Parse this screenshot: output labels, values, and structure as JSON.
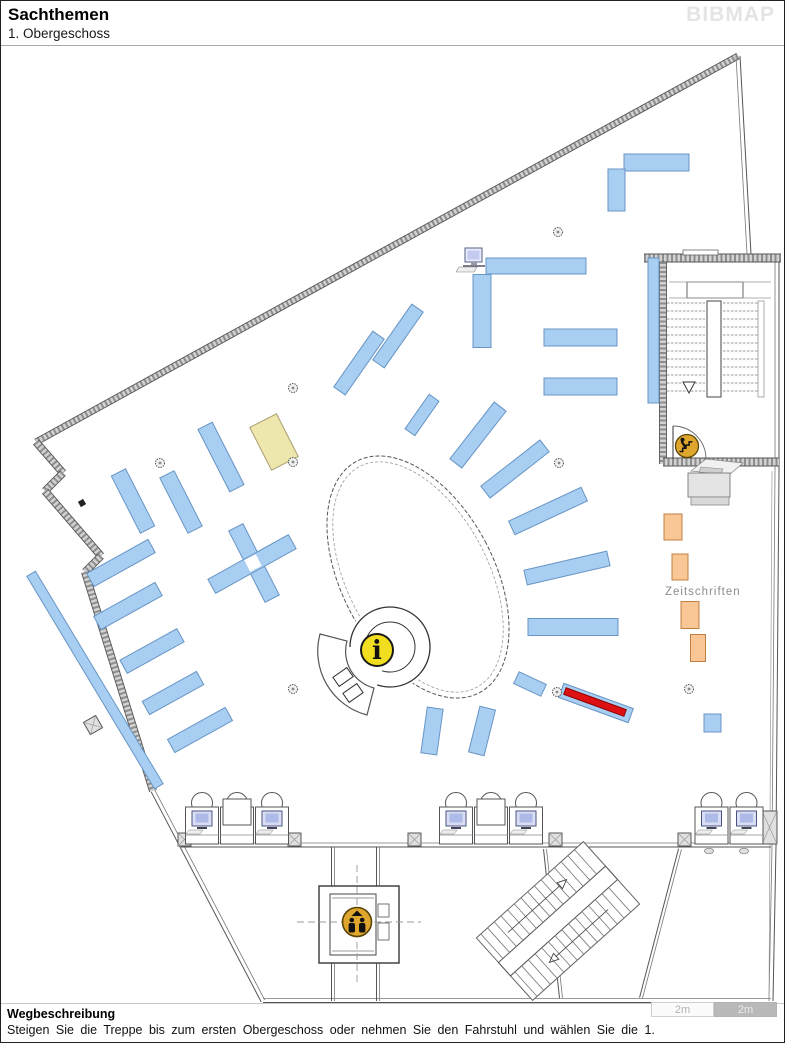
{
  "header": {
    "title": "Sachthemen",
    "subtitle": "1. Obergeschoss",
    "logo": "BIBMAP"
  },
  "footer": {
    "heading": "Wegbeschreibung",
    "text": "Steigen Sie die Treppe bis zum ersten Obergeschoss oder nehmen Sie den Fahrstuhl und wählen Sie die 1.",
    "scale_left": "2m",
    "scale_right": "2m"
  },
  "map": {
    "labels": {
      "zeitschriften": "Zeitschriften"
    },
    "colors": {
      "shelf_blue": "#A8CEF2",
      "shelf_blue_border": "#6795C5",
      "shelf_yellow": "#EDE7AE",
      "shelf_yellow_border": "#A8A070",
      "shelf_orange": "#F9C795",
      "shelf_orange_border": "#C08040",
      "highlight_red": "#DD1111",
      "highlight_red_border": "#8B0000",
      "icon_gold": "#DFA62E",
      "icon_gold_border": "#5a4408",
      "info_yellow": "#F2DE20"
    },
    "shelves": [
      {
        "cx": 655.5,
        "cy": 161.5,
        "l": 65,
        "w": 17,
        "a": 90,
        "t": "blue"
      },
      {
        "cx": 615.5,
        "cy": 189,
        "l": 42,
        "w": 17,
        "a": 0,
        "t": "blue"
      },
      {
        "cx": 535,
        "cy": 265,
        "l": 100,
        "w": 16,
        "a": 90,
        "t": "blue"
      },
      {
        "cx": 481,
        "cy": 310,
        "l": 73,
        "w": 18,
        "a": 0,
        "t": "blue"
      },
      {
        "cx": 579.5,
        "cy": 336.5,
        "l": 73,
        "w": 17,
        "a": 90,
        "t": "blue"
      },
      {
        "cx": 579.5,
        "cy": 385.5,
        "l": 73,
        "w": 17,
        "a": 90,
        "t": "blue"
      },
      {
        "cx": 652.5,
        "cy": 329.5,
        "l": 145,
        "w": 11,
        "a": 0,
        "t": "blue"
      },
      {
        "cx": 358,
        "cy": 362,
        "l": 68,
        "w": 14,
        "a": 35,
        "t": "blue"
      },
      {
        "cx": 397,
        "cy": 335,
        "l": 68,
        "w": 14,
        "a": 35,
        "t": "blue"
      },
      {
        "cx": 421,
        "cy": 414,
        "l": 42,
        "w": 12,
        "a": 35,
        "t": "blue"
      },
      {
        "cx": 477,
        "cy": 434,
        "l": 72,
        "w": 15,
        "a": 38,
        "t": "blue"
      },
      {
        "cx": 514,
        "cy": 468,
        "l": 75,
        "w": 15,
        "a": 52,
        "t": "blue"
      },
      {
        "cx": 547,
        "cy": 510,
        "l": 80,
        "w": 15,
        "a": 65,
        "t": "blue"
      },
      {
        "cx": 566,
        "cy": 567,
        "l": 85,
        "w": 15,
        "a": 77,
        "t": "blue"
      },
      {
        "cx": 572,
        "cy": 626,
        "l": 90,
        "w": 17,
        "a": 90,
        "t": "blue"
      },
      {
        "cx": 529,
        "cy": 683,
        "l": 30,
        "w": 13,
        "a": 115,
        "t": "blue"
      },
      {
        "cx": 431,
        "cy": 730,
        "l": 46,
        "w": 16,
        "a": 8,
        "t": "blue"
      },
      {
        "cx": 481,
        "cy": 730,
        "l": 47,
        "w": 16,
        "a": 14,
        "t": "blue"
      },
      {
        "cx": 220,
        "cy": 456,
        "l": 70,
        "w": 16,
        "a": -27,
        "t": "blue"
      },
      {
        "cx": 180,
        "cy": 501,
        "l": 62,
        "w": 16,
        "a": -27,
        "t": "blue"
      },
      {
        "cx": 132,
        "cy": 500,
        "l": 64,
        "w": 16,
        "a": -27,
        "t": "blue"
      },
      {
        "cx": 253,
        "cy": 562,
        "l": 80,
        "w": 16,
        "a": -27,
        "t": "blue"
      },
      {
        "cx": 251,
        "cy": 563,
        "l": 92,
        "w": 16,
        "a": 61,
        "t": "blue"
      },
      {
        "cx": 120,
        "cy": 562,
        "l": 70,
        "w": 15,
        "a": 61,
        "t": "blue"
      },
      {
        "cx": 127,
        "cy": 605,
        "l": 70,
        "w": 15,
        "a": 61,
        "t": "blue"
      },
      {
        "cx": 151,
        "cy": 650,
        "l": 65,
        "w": 15,
        "a": 61,
        "t": "blue"
      },
      {
        "cx": 172,
        "cy": 692,
        "l": 62,
        "w": 15,
        "a": 61,
        "t": "blue"
      },
      {
        "cx": 199,
        "cy": 729,
        "l": 66,
        "w": 15,
        "a": 61,
        "t": "blue"
      },
      {
        "cx": 94,
        "cy": 679,
        "l": 248,
        "w": 10,
        "a": -31,
        "t": "blue"
      },
      {
        "cx": 711.5,
        "cy": 722,
        "l": 18,
        "w": 17,
        "a": 0,
        "t": "blue"
      },
      {
        "cx": 273,
        "cy": 441,
        "l": 48,
        "w": 30,
        "a": -27,
        "t": "yellow"
      },
      {
        "cx": 672,
        "cy": 526,
        "l": 26,
        "w": 18,
        "a": 0,
        "t": "orange"
      },
      {
        "cx": 679,
        "cy": 566,
        "l": 26,
        "w": 16,
        "a": 0,
        "t": "orange"
      },
      {
        "cx": 689,
        "cy": 614,
        "l": 27,
        "w": 18,
        "a": 0,
        "t": "orange"
      },
      {
        "cx": 697,
        "cy": 647,
        "l": 27,
        "w": 15,
        "a": 0,
        "t": "orange"
      }
    ],
    "cross_gap": {
      "cx": 252,
      "cy": 562,
      "size": 13,
      "a": -27
    },
    "highlight_shelf": {
      "cx": 595,
      "cy": 702,
      "l": 74,
      "w": 15,
      "a": 110,
      "red_l": 64,
      "red_w": 7
    },
    "columns": [
      [
        159,
        462
      ],
      [
        292,
        387
      ],
      [
        292,
        461
      ],
      [
        292,
        688
      ],
      [
        557,
        231
      ],
      [
        558,
        462
      ],
      [
        556,
        691
      ],
      [
        688,
        688
      ]
    ],
    "icons": {
      "info": {
        "x": 376,
        "y": 649,
        "r": 16,
        "glyph": "i"
      },
      "elevator": {
        "x": 356,
        "y": 921,
        "r": 14.5
      },
      "stairs": {
        "x": 686,
        "y": 445,
        "r": 11.5
      }
    },
    "computer_workstations": [
      {
        "x": 236,
        "y": 818,
        "desks": 3,
        "monitors": [
          0,
          2
        ]
      },
      {
        "x": 490,
        "y": 818,
        "desks": 3,
        "monitors": [
          0,
          2
        ]
      },
      {
        "x": 728,
        "y": 818,
        "desks": 2,
        "monitors": [
          0,
          1
        ]
      }
    ],
    "standalone_computer": {
      "x": 472,
      "y": 258
    }
  }
}
